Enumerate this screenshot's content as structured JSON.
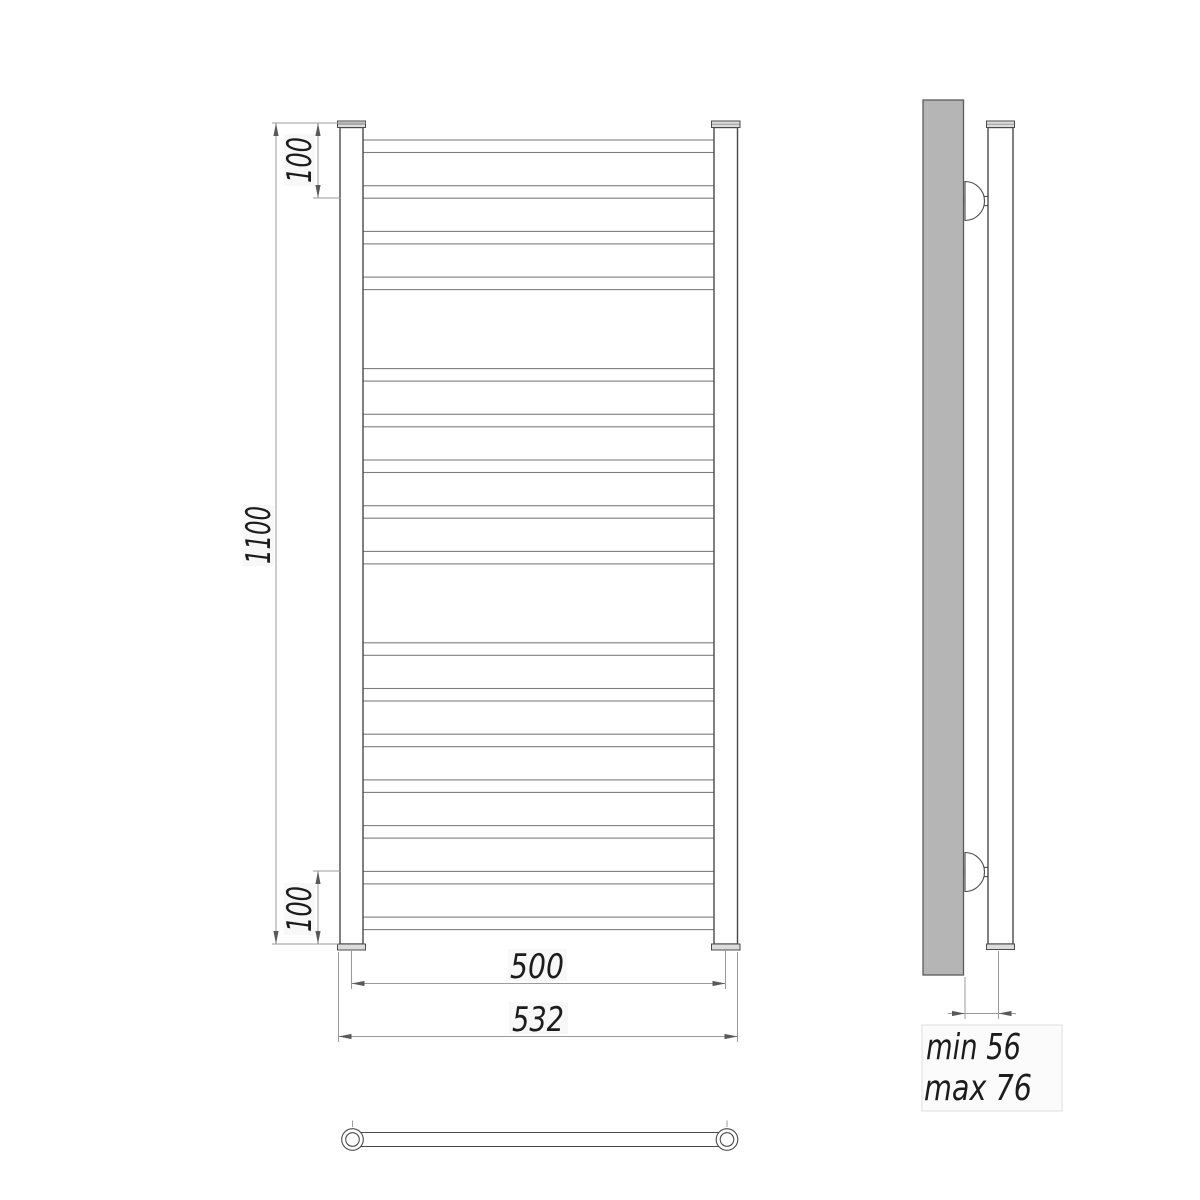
{
  "drawing": {
    "kind": "towel-rail technical drawing, front view, side view and bottom view"
  },
  "front_view": {
    "dimensions": {
      "height_total": {
        "label": "1100"
      },
      "top_offset": {
        "label": "100"
      },
      "bottom_offset": {
        "label": "100"
      },
      "width_inner": {
        "label": "500"
      },
      "width_outer": {
        "label": "532"
      }
    },
    "rungs": {
      "total": 16,
      "groups": [
        4,
        5,
        7
      ],
      "first_top_y": 140,
      "pitch": 45.71,
      "height": 12.5,
      "skip_slots": [
        4,
        10
      ],
      "x": 363,
      "width": 351
    }
  },
  "side_view": {
    "dimensions": {
      "wall_clearance_min": {
        "label": "min 56"
      },
      "wall_clearance_max": {
        "label": "max 76"
      }
    },
    "brackets": {
      "count": 2
    }
  },
  "colors": {
    "background": "#ffffff",
    "wall_fill": "#b5b5b5",
    "object_line": "#4a4a4a",
    "rung_line": "#7d7d7d",
    "dimension_line": "#9b9b9b",
    "text_color": "#1c1c1c"
  }
}
